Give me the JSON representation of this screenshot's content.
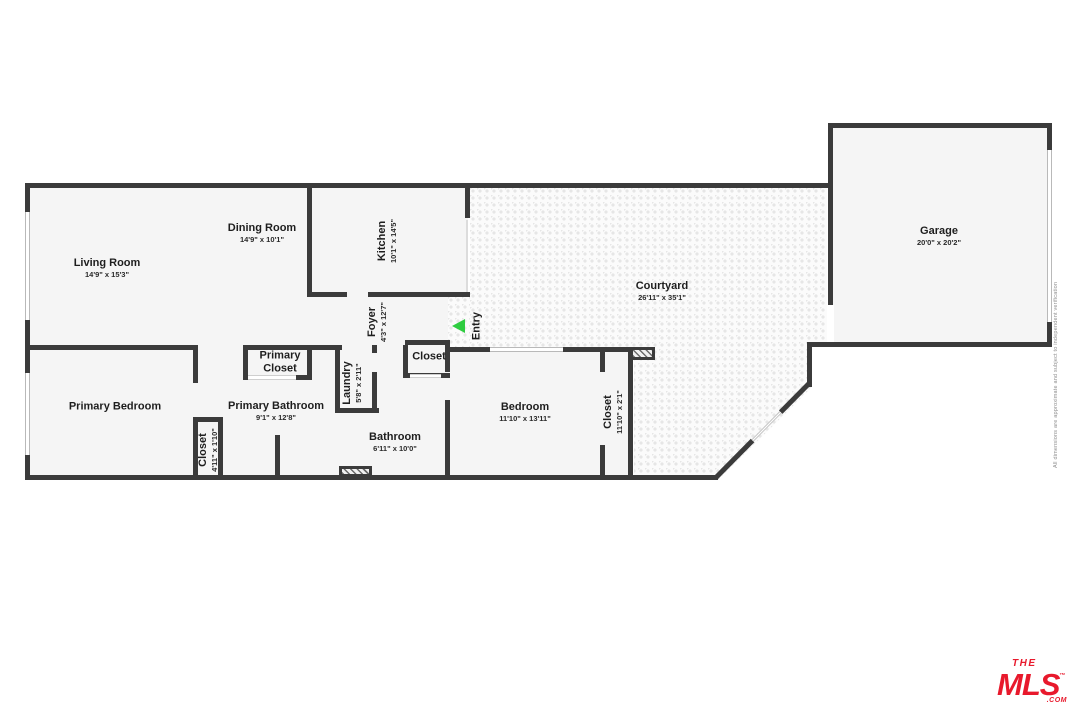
{
  "floorplan": {
    "rooms": {
      "living": {
        "name": "Living Room",
        "dims": "14'9\" x 15'3\""
      },
      "dining": {
        "name": "Dining Room",
        "dims": "14'9\" x 10'1\""
      },
      "kitchen": {
        "name": "Kitchen",
        "dims": "10'1\" x 14'5\""
      },
      "foyer": {
        "name": "Foyer",
        "dims": "4'3\" x 12'7\""
      },
      "courtyard": {
        "name": "Courtyard",
        "dims": "26'11\" x 35'1\""
      },
      "garage": {
        "name": "Garage",
        "dims": "20'0\" x 20'2\""
      },
      "primary_bedroom": {
        "name": "Primary Bedroom"
      },
      "primary_closet": {
        "name": "Primary Closet"
      },
      "primary_bathroom": {
        "name": "Primary Bathroom",
        "dims": "9'1\" x 12'8\""
      },
      "laundry": {
        "name": "Laundry",
        "dims": "5'8\" x 2'11\""
      },
      "entry_closet": {
        "name": "Closet"
      },
      "hall_closet": {
        "name": "Closet",
        "dims": "4'11\" x 1'10\""
      },
      "bathroom": {
        "name": "Bathroom",
        "dims": "6'11\" x 10'0\""
      },
      "bedroom": {
        "name": "Bedroom",
        "dims": "11'10\" x 13'11\""
      },
      "bedroom_closet": {
        "name": "Closet",
        "dims": "11'10\" x 2'1\""
      }
    },
    "entry_label": "Entry",
    "disclaimer": "All dimensions are approximate and subject to independent verification",
    "logo": {
      "line1": "THE",
      "line2": "MLS",
      "tm": "™",
      "suffix": ".COM"
    },
    "colors": {
      "wall": "#3b3b3b",
      "floor": "#f5f5f5",
      "courtyard_dot": "#e6e6e6",
      "entry_arrow": "#2ecc40",
      "logo_red": "#e8192c"
    }
  }
}
